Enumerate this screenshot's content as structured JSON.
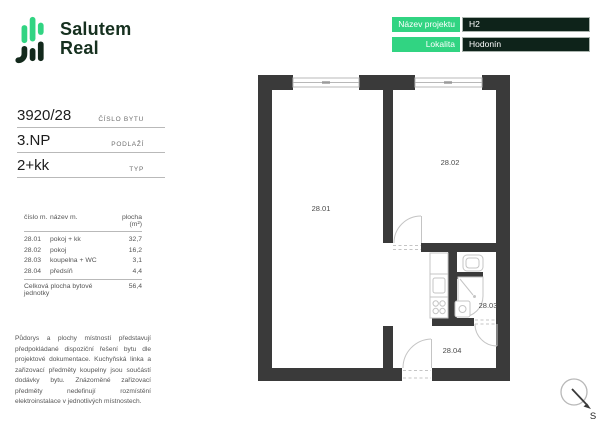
{
  "brand": {
    "line1": "Salutem",
    "line2": "Real"
  },
  "project_info": {
    "rows": [
      {
        "label": "Název projektu",
        "value": "H2"
      },
      {
        "label": "Lokalita",
        "value": "Hodonín"
      }
    ]
  },
  "unit": {
    "specs": [
      {
        "value": "3920/28",
        "label": "ČÍSLO BYTU"
      },
      {
        "value": "3.NP",
        "label": "PODLAŽÍ"
      },
      {
        "value": "2+kk",
        "label": "TYP"
      }
    ]
  },
  "room_table": {
    "headers": [
      "číslo m.",
      "název m.",
      "plocha (m²)"
    ],
    "rows": [
      {
        "number": "28.01",
        "name": "pokoj + kk",
        "area": "32,7"
      },
      {
        "number": "28.02",
        "name": "pokoj",
        "area": "16,2"
      },
      {
        "number": "28.03",
        "name": "koupelna + WC",
        "area": "3,1"
      },
      {
        "number": "28.04",
        "name": "předsíň",
        "area": "4,4"
      }
    ],
    "total_label": "Celková plocha bytové jednotky",
    "total_value": "56,4"
  },
  "disclaimer": "Půdorys a plochy místností představují předpokládané dispoziční řešení bytu dle projektové dokumentace. Kuchyňská linka a zařizovací předměty koupelny jsou součástí dodávky bytu. Znázorněné zařizovací předměty nedefinují rozmístění elektroinstalace v jednotlivých místnostech.",
  "floorplan": {
    "room_labels": [
      {
        "id": "28.01"
      },
      {
        "id": "28.02"
      },
      {
        "id": "28.03"
      },
      {
        "id": "28.04"
      }
    ]
  },
  "compass": {
    "north_label": "S"
  },
  "colors": {
    "accent_green": "#31d482",
    "dark_green": "#0e231a",
    "wall": "#3a3a3a"
  }
}
